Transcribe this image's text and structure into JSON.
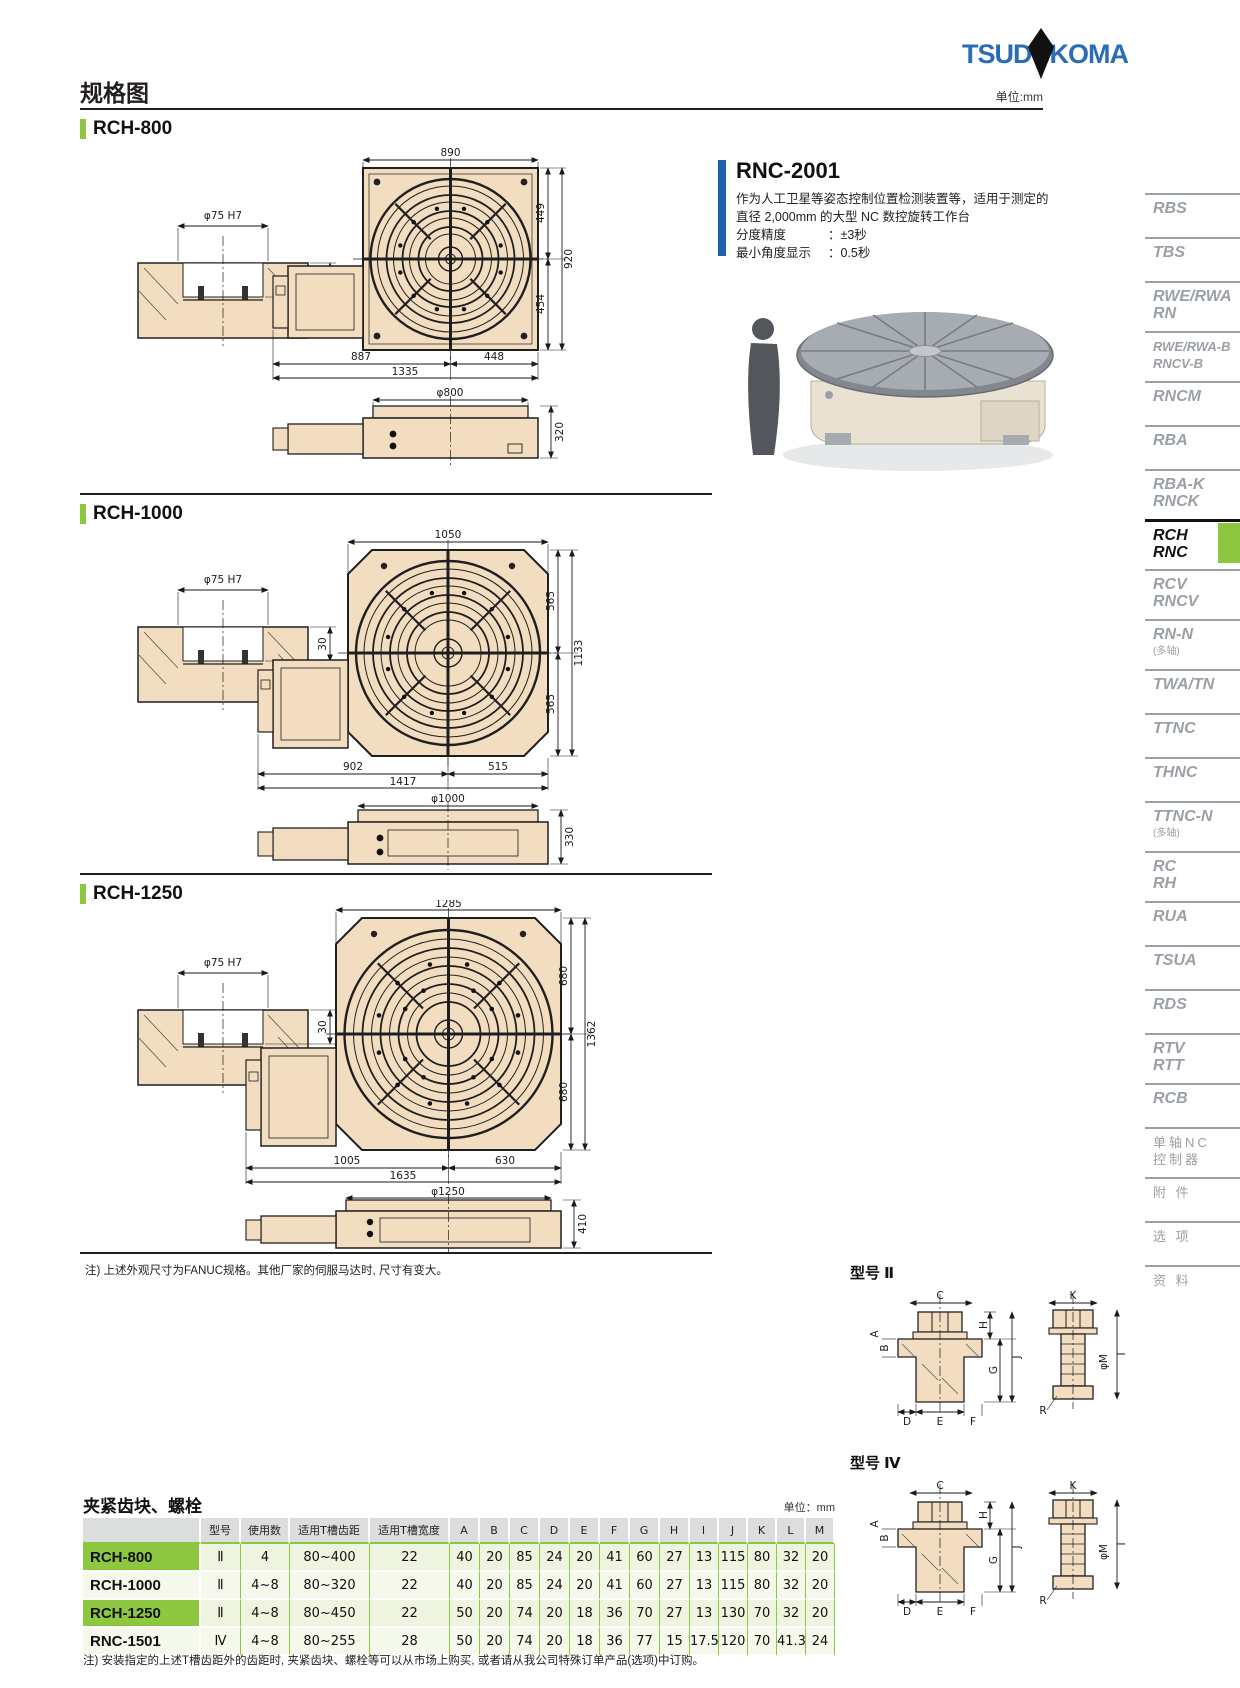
{
  "page": {
    "title": "规格图",
    "unit_top": "单位:mm",
    "logo": {
      "left": "TSUD",
      "right": "KOMA"
    }
  },
  "rnc2001": {
    "title": "RNC-2001",
    "desc1": "作为人工卫星等姿态控制位置检测装置等，适用于测定的",
    "desc2": "直径 2,000mm 的大型 NC 数控旋转工作台",
    "spec1_label": "分度精度",
    "spec1_value": "：±3秒",
    "spec2_label": "最小角度显示",
    "spec2_value": "：0.5秒"
  },
  "sections": [
    {
      "title": "RCH-800",
      "cross": {
        "dia": "φ75 H7",
        "depth": "30"
      },
      "top": {
        "w": "890",
        "ru": "449",
        "rt": "920",
        "rl": "454",
        "bl": "887",
        "br": "448",
        "bt": "1335"
      },
      "side": {
        "dia": "φ800",
        "h": "320"
      }
    },
    {
      "title": "RCH-1000",
      "cross": {
        "dia": "φ75 H7",
        "depth": "30"
      },
      "top": {
        "w": "1050",
        "ru": "565",
        "rt": "1133",
        "rl": "565",
        "bl": "902",
        "br": "515",
        "bt": "1417"
      },
      "side": {
        "dia": "φ1000",
        "h": "330"
      }
    },
    {
      "title": "RCH-1250",
      "cross": {
        "dia": "φ75 H7",
        "depth": "30"
      },
      "top": {
        "w": "1285",
        "ru": "680",
        "rt": "1362",
        "rl": "680",
        "bl": "1005",
        "br": "630",
        "bt": "1635"
      },
      "side": {
        "dia": "φ1250",
        "h": "410"
      }
    }
  ],
  "fanuc_note": "注) 上述外观尺寸为FANUC规格。其他厂家的伺服马达时, 尺寸有变大。",
  "sidebar": {
    "items": [
      {
        "l1": "RBS",
        "l2": ""
      },
      {
        "l1": "TBS",
        "l2": ""
      },
      {
        "l1": "RWE/RWA",
        "l2": "RN"
      },
      {
        "l1": "RWE/RWA-B",
        "l2": "RNCV-B"
      },
      {
        "l1": "RNCM",
        "l2": ""
      },
      {
        "l1": "RBA",
        "l2": ""
      },
      {
        "l1": "RBA-K",
        "l2": "RNCK"
      },
      {
        "l1": "RCH",
        "l2": "RNC"
      },
      {
        "l1": "RCV",
        "l2": "RNCV"
      },
      {
        "l1": "RN-N",
        "l2": "(多轴)"
      },
      {
        "l1": "TWA/TN",
        "l2": ""
      },
      {
        "l1": "TTNC",
        "l2": ""
      },
      {
        "l1": "THNC",
        "l2": ""
      },
      {
        "l1": "TTNC-N",
        "l2": "(多轴)"
      },
      {
        "l1": "RC",
        "l2": "RH"
      },
      {
        "l1": "RUA",
        "l2": ""
      },
      {
        "l1": "TSUA",
        "l2": ""
      },
      {
        "l1": "RDS",
        "l2": ""
      },
      {
        "l1": "RTV",
        "l2": "RTT"
      },
      {
        "l1": "RCB",
        "l2": ""
      },
      {
        "l1": "单轴NC",
        "l2": "控制器"
      },
      {
        "l1": "附 件",
        "l2": ""
      },
      {
        "l1": "选 项",
        "l2": ""
      },
      {
        "l1": "资 料",
        "l2": ""
      }
    ]
  },
  "type2": {
    "label": "型号 Ⅱ"
  },
  "type4": {
    "label": "型号 Ⅳ"
  },
  "bolt": {
    "c": "C",
    "h": "H",
    "a": "A",
    "b": "B",
    "g": "G",
    "j": "J",
    "d": "D",
    "e": "E",
    "f": "F",
    "k": "K",
    "m": "φM",
    "r": "R",
    "i": "I"
  },
  "clamp_table": {
    "title": "夹紧齿块、螺栓",
    "unit": "单位：mm",
    "headers": {
      "model": "型号",
      "qty": "使用数",
      "pitch": "适用T槽齿距",
      "width": "适用T槽宽度",
      "cols": [
        "A",
        "B",
        "C",
        "D",
        "E",
        "F",
        "G",
        "H",
        "I",
        "J",
        "K",
        "L",
        "M"
      ]
    },
    "rows": [
      {
        "name": "RCH-800",
        "type": "Ⅱ",
        "qty": "4",
        "pitch": "80~400",
        "width": "22",
        "vals": [
          "40",
          "20",
          "85",
          "24",
          "20",
          "41",
          "60",
          "27",
          "13",
          "115",
          "80",
          "32",
          "20"
        ]
      },
      {
        "name": "RCH-1000",
        "type": "Ⅱ",
        "qty": "4~8",
        "pitch": "80~320",
        "width": "22",
        "vals": [
          "40",
          "20",
          "85",
          "24",
          "20",
          "41",
          "60",
          "27",
          "13",
          "115",
          "80",
          "32",
          "20"
        ]
      },
      {
        "name": "RCH-1250",
        "type": "Ⅱ",
        "qty": "4~8",
        "pitch": "80~450",
        "width": "22",
        "vals": [
          "50",
          "20",
          "74",
          "20",
          "18",
          "36",
          "70",
          "27",
          "13",
          "130",
          "70",
          "32",
          "20"
        ]
      },
      {
        "name": "RNC-1501",
        "type": "Ⅳ",
        "qty": "4~8",
        "pitch": "80~255",
        "width": "28",
        "vals": [
          "50",
          "20",
          "74",
          "20",
          "18",
          "36",
          "77",
          "15",
          "17.5",
          "120",
          "70",
          "41.3",
          "24"
        ]
      }
    ]
  },
  "bottom_note": "注) 安装指定的上述T槽齿距外的齿距时, 夹紧齿块、螺栓等可以从市场上购买, 或者请从我公司特殊订单产品(选项)中订购。"
}
